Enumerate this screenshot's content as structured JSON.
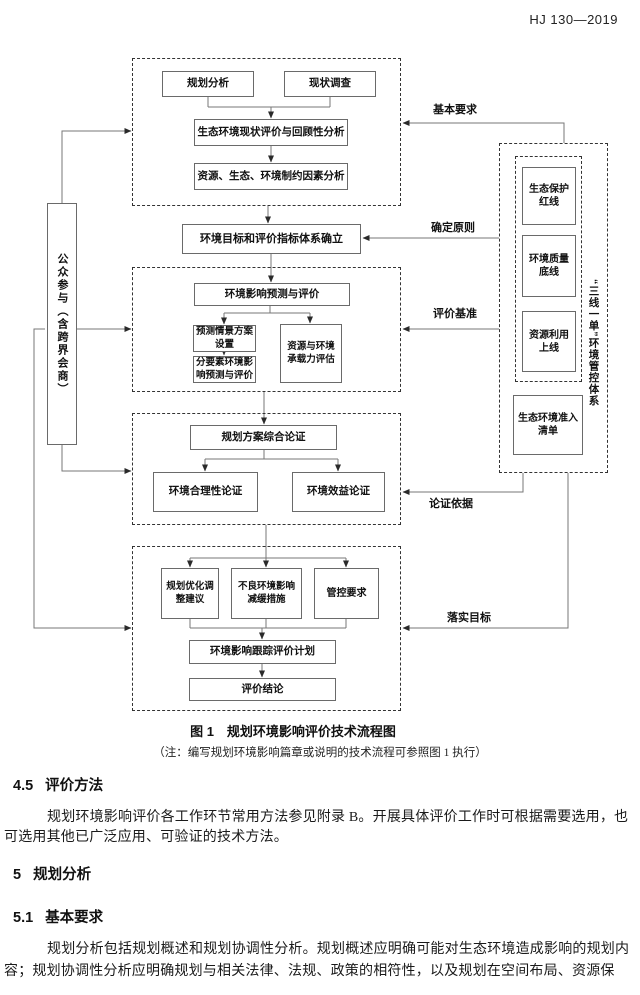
{
  "header": {
    "standard_no": "HJ 130—2019"
  },
  "figure": {
    "caption": "图 1　规划环境影响评价技术流程图",
    "note": "（注：编写规划环境影响篇章或说明的技术流程可参照图 1 执行）",
    "nodes": {
      "planning_analysis": "规划分析",
      "status_survey": "现状调查",
      "eco_status_eval": "生态环境现状评价与回顾性分析",
      "constraint_analysis": "资源、生态、环境制约因素分析",
      "env_targets": "环境目标和评价指标体系确立",
      "impact_prediction": "环境影响预测与评价",
      "scenario_setting": "预测情景方案设置",
      "factor_prediction": "分要素环境影响预测与评价",
      "carrying_capacity": "资源与环境承载力评估",
      "comprehensive_demo": "规划方案综合论证",
      "env_rationality": "环境合理性论证",
      "env_benefit": "环境效益论证",
      "optimization_advice": "规划优化调整建议",
      "mitigation_measures": "不良环境影响减缓措施",
      "control_requirements": "管控要求",
      "tracking_plan": "环境影响跟踪评价计划",
      "conclusion": "评价结论",
      "public_participation": "公众参与（含跨界会商）",
      "eco_redline": "生态保护红线",
      "env_quality_bottomline": "环境质量底线",
      "resource_upperline": "资源利用上线",
      "access_list": "生态环境准入清单",
      "three_lines_one_list": "“三线一单”环境管控体系"
    },
    "edge_labels": {
      "basic_requirements": "基本要求",
      "determine_principles": "确定原则",
      "evaluation_benchmark": "评价基准",
      "demonstration_basis": "论证依据",
      "implement_goals": "落实目标"
    }
  },
  "sections": [
    {
      "num": "4.5",
      "title": "评价方法",
      "lines": [
        "规划环境影响评价各工作环节常用方法参见附录 B。开展具体评价工作时可根据需要选用，也",
        "可选用其他已广泛应用、可验证的技术方法。"
      ]
    },
    {
      "num": "5",
      "title": "规划分析",
      "lines": []
    },
    {
      "num": "5.1",
      "title": "基本要求",
      "lines": [
        "规划分析包括规划概述和规划协调性分析。规划概述应明确可能对生态环境造成影响的规划内",
        "容；规划协调性分析应明确规划与相关法律、法规、政策的相符性，以及规划在空间布局、资源保"
      ]
    }
  ]
}
